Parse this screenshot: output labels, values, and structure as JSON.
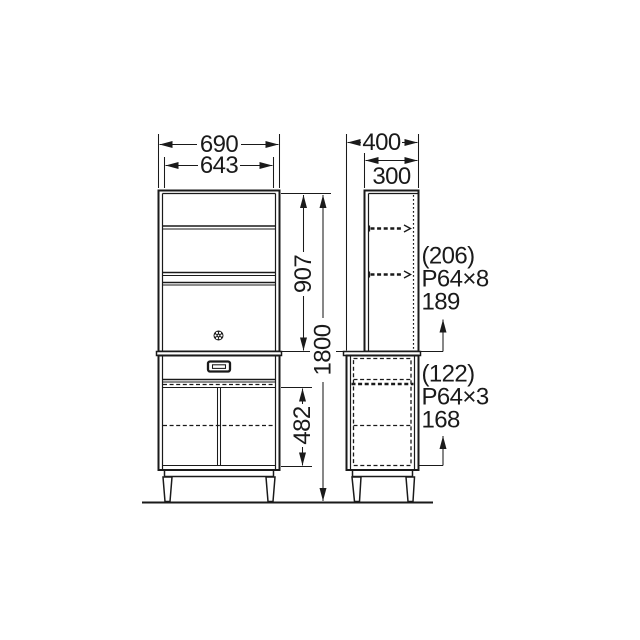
{
  "canvas": {
    "background": "#ffffff",
    "line_color": "#1a1a1a"
  },
  "dims": {
    "width_outer": "690",
    "width_inner": "643",
    "upper_height": "907",
    "total_height": "1800",
    "lower_inner_height": "482",
    "depth_total": "400",
    "depth_upper": "300"
  },
  "notes": {
    "upper": {
      "clearance": "(206)",
      "pitch": "P64×8",
      "base": "189"
    },
    "lower": {
      "clearance": "(122)",
      "pitch": "P64×3",
      "base": "168"
    }
  },
  "icons": {
    "door_knob": "rosette-knob-icon",
    "drawer_handle": "recessed-pull-icon"
  }
}
